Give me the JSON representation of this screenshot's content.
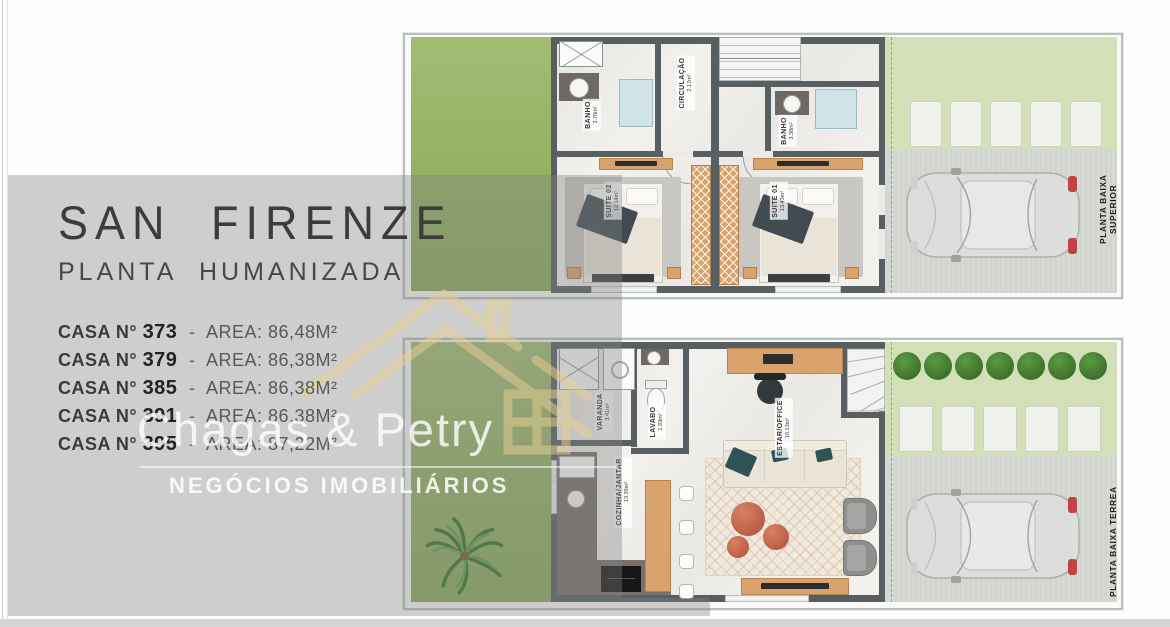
{
  "info": {
    "title": "SAN FIRENZE",
    "subtitle": "PLANTA HUMANIZADA",
    "unit_label": "CASA N°",
    "separator": "-",
    "area_label": "AREA:",
    "units": [
      {
        "number": "373",
        "area": "86,48M²"
      },
      {
        "number": "379",
        "area": "86,38M²"
      },
      {
        "number": "385",
        "area": "86,38M²"
      },
      {
        "number": "391",
        "area": "86,38M²"
      },
      {
        "number": "395",
        "area": "87,22M²"
      }
    ]
  },
  "watermark": {
    "brand": "Chagas & Petry",
    "tagline": "NEGÓCIOS IMOBILIÁRIOS"
  },
  "plans": {
    "upper": {
      "side_label": "PLANTA BAIXA SUPERIOR",
      "rooms": {
        "banho1": {
          "name": "BANHO",
          "area": "3.70m²"
        },
        "circulacao": {
          "name": "CIRCULAÇÃO",
          "area": "2.17m²"
        },
        "banho2": {
          "name": "BANHO",
          "area": "3.38m²"
        },
        "suite02": {
          "name": "SUITE 02",
          "area": "12.14m²"
        },
        "suite01": {
          "name": "SUITE 01",
          "area": "13.43m²"
        }
      }
    },
    "lower": {
      "side_label": "PLANTA BAIXA TERREA",
      "rooms": {
        "varanda": {
          "name": "VARANDA",
          "area": "3.41m²"
        },
        "lavabo": {
          "name": "LAVABO",
          "area": "1.93m²"
        },
        "estar": {
          "name": "ESTAR/OFFICE",
          "area": "16.13m²"
        },
        "cozinha": {
          "name": "COZINHA/JANTAR",
          "area": "13.39m²"
        }
      }
    }
  },
  "colors": {
    "accent_gold": "#e8d093",
    "grass_green": "#93b163",
    "grass_light": "#d3dfb6",
    "wall_gray": "#575f63",
    "wood": "#d9a36e",
    "coral_pouf": "#c4674d",
    "taillight_red": "#c14343",
    "overlay_gray": "#9e9e9e"
  }
}
